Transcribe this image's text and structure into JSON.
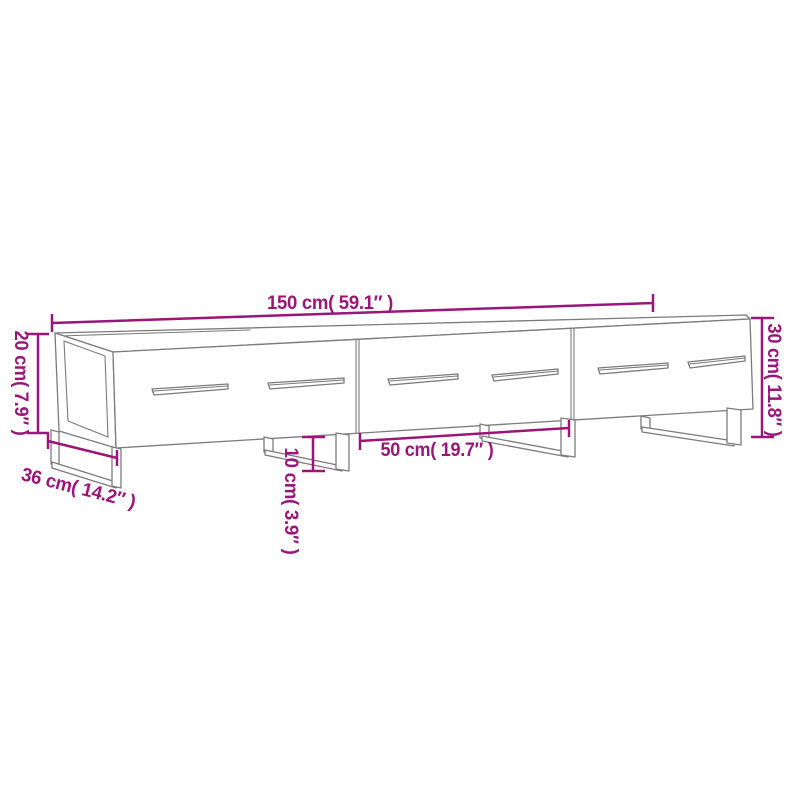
{
  "colors": {
    "background": "#ffffff",
    "dimension_magenta": "#9a1678",
    "outline_gray": "#7b7b7b"
  },
  "diagram": {
    "subject": "TV cabinet with 3 drawers and metal legs",
    "dims": {
      "width": {
        "label": "150 cm( 59.1″ )",
        "cm": "150",
        "inch": "59.1"
      },
      "carcass_height": {
        "label": "20 cm( 7.9″ )",
        "cm": "20",
        "inch": "7.9"
      },
      "total_height": {
        "label": "30 cm( 11.8″ )",
        "cm": "30",
        "inch": "11.8"
      },
      "depth": {
        "label": "36 cm( 14.2″ )",
        "cm": "36",
        "inch": "14.2"
      },
      "drawer_width": {
        "label": "50 cm( 19.7″ )",
        "cm": "50",
        "inch": "19.7"
      },
      "leg_height": {
        "label": "10 cm( 3.9″ )",
        "cm": "10",
        "inch": "3.9"
      }
    }
  }
}
